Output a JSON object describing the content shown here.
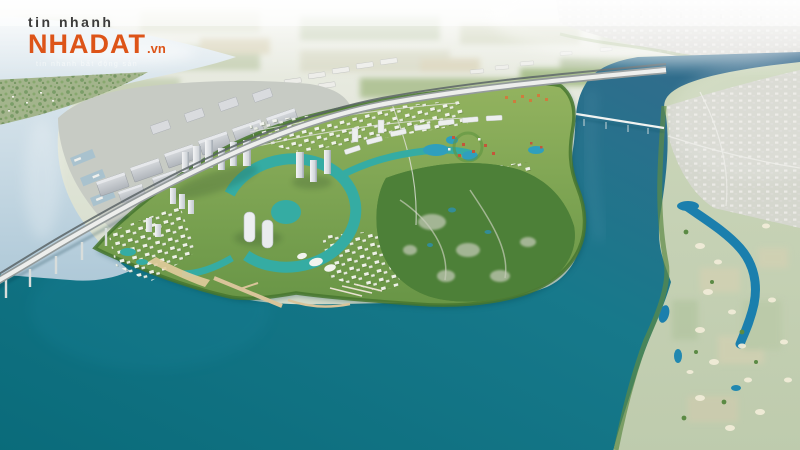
{
  "watermark": {
    "prefix": "tin nhanh",
    "brand": "NHADAT",
    "tld": ".vn",
    "tagline": "tin nhanh bất động sản"
  },
  "scene": {
    "type": "aerial-3d-masterplan-render",
    "subject": "riverside eco-township on a green peninsula in a river bend",
    "palette": {
      "brand_orange": "#DD5418",
      "open_water_teal": "#0E6F7E",
      "river_blue": "#2E6B8E",
      "pale_river": "#C6D8E3",
      "canal_turquoise": "#35ACA3",
      "golf_lake_blue": "#1B7FAD",
      "greenery": "#7FA851",
      "forest": "#4E8038",
      "distant_plains": "#CBD3BE",
      "industrial_roof": "#C4C8CE",
      "road_white": "#EDEEEC",
      "sand_pier": "#D9C49A"
    },
    "landmarks": [
      "pale-river-northwest",
      "expressway-rail-corridor",
      "expressway-bridge",
      "industrial-port",
      "warehouse-district",
      "distant-town-blocks",
      "township-peninsula",
      "highrise-clusters",
      "central-canal-loop",
      "theme-park-lagoons",
      "villa-districts",
      "forest-reserve",
      "marina-piers",
      "south-bay-open-water",
      "east-river",
      "east-river-bridge",
      "riverside-town-east",
      "golf-course-east",
      "golf-lakes",
      "distant-city-skyline"
    ]
  }
}
